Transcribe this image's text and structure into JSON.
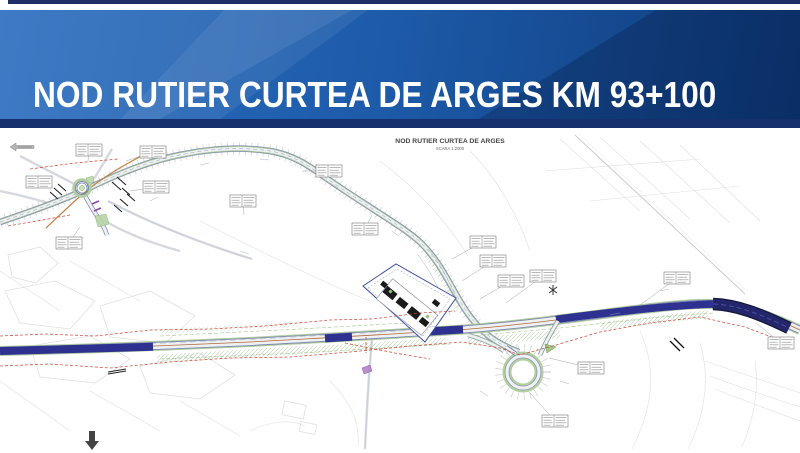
{
  "banner": {
    "title": "NOD RUTIER CURTEA DE ARGES KM 93+100"
  },
  "map": {
    "title": "NOD RUTIER CURTEA DE ARGES",
    "scale_label": "SCARA 1:2000"
  },
  "colors": {
    "banner_top_bar": "#1f2e66",
    "banner_grad_left": "#2e6fc0",
    "banner_grad_mid": "#1e5cab",
    "banner_grad_right": "#0d3a79",
    "banner_bottom": "#16306e",
    "title_text": "#ffffff",
    "map_bg": "#ffffff",
    "motorway_blue": "#2f3191",
    "bridge_dark": "#23266b",
    "bridge_edge": "#15173a",
    "road_casing": "#7d8aae",
    "road_fill": "#eef0f4",
    "verge_green": "#a8c796",
    "island_green": "#8fbf71",
    "loop_green": "#b3cf9f",
    "axis_brown": "#b06a3a",
    "red_dash": "#cc4433",
    "orange_road": "#c07a3c",
    "purple_structure": "#8e44ad",
    "cadastral": "#e0e0e4",
    "hatch_green": "#9cc08a",
    "label_gray": "#999999",
    "ink": "#444444"
  }
}
